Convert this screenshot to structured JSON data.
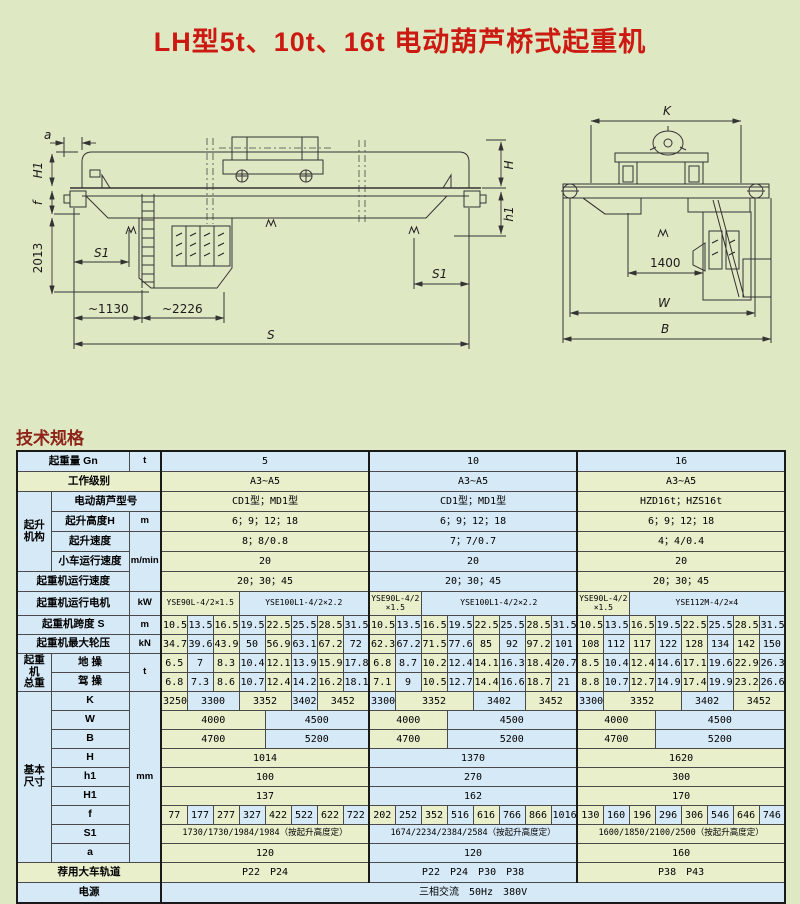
{
  "page": {
    "title": "LH型5t、10t、16t 电动葫芦桥式起重机",
    "section_title": "技术规格"
  },
  "colors": {
    "page_bg": "#dee9c4",
    "title_red": "#cc1a12",
    "section_red": "#8e2318",
    "cell_green": "#e9eecb",
    "cell_blue": "#d6e9f6",
    "line": "#333333"
  },
  "drawings": {
    "side": {
      "a": "a",
      "H1": "H1",
      "f": "f",
      "v2013": "2013",
      "s1": "S1",
      "d1130": "~1130",
      "d2226": "~2226",
      "S": "S",
      "H": "H",
      "h1": "h1"
    },
    "end": {
      "K": "K",
      "d1400": "1400",
      "W": "W",
      "B": "B"
    }
  },
  "table": {
    "capacity_sections": [
      "5",
      "10",
      "16"
    ],
    "rows": [
      {
        "id": "capacity",
        "rc": "h19",
        "cells": [
          {
            "t": "起重量 Gn",
            "k": "lab",
            "cs": 2
          },
          {
            "t": "t",
            "k": "unit"
          },
          {
            "t": "5",
            "cs": 8,
            "tn": "b"
          },
          {
            "t": "10",
            "cs": 8,
            "tn": "b"
          },
          {
            "t": "16",
            "cs": 8,
            "tn": "b"
          }
        ]
      },
      {
        "id": "duty-class",
        "rc": "h19",
        "cells": [
          {
            "t": "工作级别",
            "k": "lab",
            "cs": 3,
            "tn": "g"
          },
          {
            "t": "A3~A5",
            "cs": 8
          },
          {
            "t": "A3~A5",
            "cs": 8
          },
          {
            "t": "A3~A5",
            "cs": 8
          }
        ]
      },
      {
        "id": "hoist-model",
        "rc": "h19",
        "cells": [
          {
            "t": "起升\n机构",
            "k": "grp",
            "rs": 4
          },
          {
            "t": "电动葫芦型号",
            "k": "lab",
            "cs": 2
          },
          {
            "t": "CD1型；MD1型",
            "cs": 8
          },
          {
            "t": "CD1型；MD1型",
            "cs": 8
          },
          {
            "t": "HZD16t；HZS16t",
            "cs": 8
          }
        ]
      },
      {
        "id": "lift-height",
        "rc": "h19",
        "cells": [
          {
            "t": "起升高度H",
            "k": "lab"
          },
          {
            "t": "m",
            "k": "unit"
          },
          {
            "t": "6；9；12；18",
            "cs": 8
          },
          {
            "t": "6；9；12；18",
            "cs": 8
          },
          {
            "t": "6；9；12；18",
            "cs": 8
          }
        ]
      },
      {
        "id": "lift-speed",
        "rc": "h19",
        "cells": [
          {
            "t": "起升速度",
            "k": "lab"
          },
          {
            "t": "m/min",
            "k": "unit",
            "rs": 3
          },
          {
            "t": "8；8/0.8",
            "cs": 8
          },
          {
            "t": "7；7/0.7",
            "cs": 8
          },
          {
            "t": "4；4/0.4",
            "cs": 8
          }
        ]
      },
      {
        "id": "trolley-speed",
        "rc": "h19",
        "cells": [
          {
            "t": "小车运行速度",
            "k": "lab"
          },
          {
            "t": "20",
            "cs": 8
          },
          {
            "t": "20",
            "cs": 8
          },
          {
            "t": "20",
            "cs": 8
          }
        ]
      },
      {
        "id": "crane-speed",
        "rc": "h19",
        "cells": [
          {
            "t": "起重机运行速度",
            "k": "lab",
            "cs": 2
          },
          {
            "t": "20；30；45",
            "cs": 8
          },
          {
            "t": "20；30；45",
            "cs": 8
          },
          {
            "t": "20；30；45",
            "cs": 8
          }
        ]
      },
      {
        "id": "travel-motor",
        "rc": "h23 motors",
        "cells": [
          {
            "t": "起重机运行电机",
            "k": "lab",
            "cs": 2
          },
          {
            "t": "kW",
            "k": "unit"
          },
          {
            "t": "YSE90L-4/2×1.5",
            "cs": 3
          },
          {
            "t": "YSE100L1-4/2×2.2",
            "cs": 5
          },
          {
            "t": "YSE90L-4/2\n×1.5",
            "cs": 2
          },
          {
            "t": "YSE100L1-4/2×2.2",
            "cs": 6
          },
          {
            "t": "YSE90L-4/2\n×1.5",
            "cs": 2
          },
          {
            "t": "YSE112M-4/2×4",
            "cs": 6
          }
        ]
      },
      {
        "id": "span",
        "cells": [
          {
            "t": "起重机跨度 S",
            "k": "lab",
            "cs": 2
          },
          {
            "t": "m",
            "k": "unit"
          },
          {
            "t": "10.5"
          },
          {
            "t": "13.5"
          },
          {
            "t": "16.5"
          },
          {
            "t": "19.5"
          },
          {
            "t": "22.5"
          },
          {
            "t": "25.5"
          },
          {
            "t": "28.5"
          },
          {
            "t": "31.5"
          },
          {
            "t": "10.5"
          },
          {
            "t": "13.5"
          },
          {
            "t": "16.5"
          },
          {
            "t": "19.5"
          },
          {
            "t": "22.5"
          },
          {
            "t": "25.5"
          },
          {
            "t": "28.5"
          },
          {
            "t": "31.5"
          },
          {
            "t": "10.5"
          },
          {
            "t": "13.5"
          },
          {
            "t": "16.5"
          },
          {
            "t": "19.5"
          },
          {
            "t": "22.5"
          },
          {
            "t": "25.5"
          },
          {
            "t": "28.5"
          },
          {
            "t": "31.5"
          }
        ]
      },
      {
        "id": "max-wheel-load",
        "cells": [
          {
            "t": "起重机最大轮压",
            "k": "lab",
            "cs": 2
          },
          {
            "t": "kN",
            "k": "unit"
          },
          {
            "t": "34.7"
          },
          {
            "t": "39.6"
          },
          {
            "t": "43.9"
          },
          {
            "t": "50"
          },
          {
            "t": "56.9"
          },
          {
            "t": "63.1"
          },
          {
            "t": "67.2"
          },
          {
            "t": "72"
          },
          {
            "t": "62.3"
          },
          {
            "t": "67.2"
          },
          {
            "t": "71.5"
          },
          {
            "t": "77.6"
          },
          {
            "t": "85"
          },
          {
            "t": "92"
          },
          {
            "t": "97.2"
          },
          {
            "t": "101"
          },
          {
            "t": "108"
          },
          {
            "t": "112"
          },
          {
            "t": "117"
          },
          {
            "t": "122"
          },
          {
            "t": "128"
          },
          {
            "t": "134"
          },
          {
            "t": "142"
          },
          {
            "t": "150"
          }
        ]
      },
      {
        "id": "weight-ground",
        "cells": [
          {
            "t": "起重\n机\n总重",
            "k": "grp",
            "rs": 2
          },
          {
            "t": "地 操",
            "k": "lab"
          },
          {
            "t": "t",
            "k": "unit",
            "rs": 2
          },
          {
            "t": "6.5"
          },
          {
            "t": "7"
          },
          {
            "t": "8.3"
          },
          {
            "t": "10.4"
          },
          {
            "t": "12.1"
          },
          {
            "t": "13.9"
          },
          {
            "t": "15.9"
          },
          {
            "t": "17.8"
          },
          {
            "t": "6.8"
          },
          {
            "t": "8.7"
          },
          {
            "t": "10.2"
          },
          {
            "t": "12.4"
          },
          {
            "t": "14.1"
          },
          {
            "t": "16.3"
          },
          {
            "t": "18.4"
          },
          {
            "t": "20.7"
          },
          {
            "t": "8.5"
          },
          {
            "t": "10.4"
          },
          {
            "t": "12.4"
          },
          {
            "t": "14.6"
          },
          {
            "t": "17.1"
          },
          {
            "t": "19.6"
          },
          {
            "t": "22.9"
          },
          {
            "t": "26.3"
          }
        ]
      },
      {
        "id": "weight-cab",
        "cells": [
          {
            "t": "驾 操",
            "k": "lab"
          },
          {
            "t": "6.8"
          },
          {
            "t": "7.3"
          },
          {
            "t": "8.6"
          },
          {
            "t": "10.7"
          },
          {
            "t": "12.4"
          },
          {
            "t": "14.2"
          },
          {
            "t": "16.2"
          },
          {
            "t": "18.1"
          },
          {
            "t": "7.1"
          },
          {
            "t": "9"
          },
          {
            "t": "10.5"
          },
          {
            "t": "12.7"
          },
          {
            "t": "14.4"
          },
          {
            "t": "16.6"
          },
          {
            "t": "18.7"
          },
          {
            "t": "21"
          },
          {
            "t": "8.8"
          },
          {
            "t": "10.7"
          },
          {
            "t": "12.7"
          },
          {
            "t": "14.9"
          },
          {
            "t": "17.4"
          },
          {
            "t": "19.9"
          },
          {
            "t": "23.2"
          },
          {
            "t": "26.6"
          }
        ]
      },
      {
        "id": "dim-K",
        "cells": [
          {
            "t": "基本\n尺寸",
            "k": "grp",
            "rs": 9
          },
          {
            "t": "K",
            "k": "lab"
          },
          {
            "t": "mm",
            "k": "unit",
            "rs": 9
          },
          {
            "t": "3250"
          },
          {
            "t": "3300",
            "cs": 2
          },
          {
            "t": "3352",
            "cs": 2
          },
          {
            "t": "3402"
          },
          {
            "t": "3452",
            "cs": 2
          },
          {
            "t": "3300"
          },
          {
            "t": "3352",
            "cs": 3
          },
          {
            "t": "3402",
            "cs": 2
          },
          {
            "t": "3452",
            "cs": 2
          },
          {
            "t": "3300"
          },
          {
            "t": "3352",
            "cs": 3
          },
          {
            "t": "3402",
            "cs": 2
          },
          {
            "t": "3452",
            "cs": 2
          }
        ]
      },
      {
        "id": "dim-W",
        "cells": [
          {
            "t": "W",
            "k": "lab"
          },
          {
            "t": "4000",
            "cs": 4
          },
          {
            "t": "4500",
            "cs": 4
          },
          {
            "t": "4000",
            "cs": 3
          },
          {
            "t": "4500",
            "cs": 5
          },
          {
            "t": "4000",
            "cs": 3
          },
          {
            "t": "4500",
            "cs": 5
          }
        ]
      },
      {
        "id": "dim-B",
        "cells": [
          {
            "t": "B",
            "k": "lab"
          },
          {
            "t": "4700",
            "cs": 4
          },
          {
            "t": "5200",
            "cs": 4
          },
          {
            "t": "4700",
            "cs": 3
          },
          {
            "t": "5200",
            "cs": 5
          },
          {
            "t": "4700",
            "cs": 3
          },
          {
            "t": "5200",
            "cs": 5
          }
        ]
      },
      {
        "id": "dim-H",
        "cells": [
          {
            "t": "H",
            "k": "lab"
          },
          {
            "t": "1014",
            "cs": 8
          },
          {
            "t": "1370",
            "cs": 8
          },
          {
            "t": "1620",
            "cs": 8
          }
        ]
      },
      {
        "id": "dim-h1",
        "cells": [
          {
            "t": "h1",
            "k": "lab"
          },
          {
            "t": "100",
            "cs": 8
          },
          {
            "t": "270",
            "cs": 8
          },
          {
            "t": "300",
            "cs": 8
          }
        ]
      },
      {
        "id": "dim-H1",
        "cells": [
          {
            "t": "H1",
            "k": "lab"
          },
          {
            "t": "137",
            "cs": 8
          },
          {
            "t": "162",
            "cs": 8
          },
          {
            "t": "170",
            "cs": 8
          }
        ]
      },
      {
        "id": "dim-f",
        "cells": [
          {
            "t": "f",
            "k": "lab"
          },
          {
            "t": "77"
          },
          {
            "t": "177"
          },
          {
            "t": "277"
          },
          {
            "t": "327"
          },
          {
            "t": "422"
          },
          {
            "t": "522"
          },
          {
            "t": "622"
          },
          {
            "t": "722"
          },
          {
            "t": "202"
          },
          {
            "t": "252"
          },
          {
            "t": "352"
          },
          {
            "t": "516"
          },
          {
            "t": "616"
          },
          {
            "t": "766"
          },
          {
            "t": "866"
          },
          {
            "t": "1016"
          },
          {
            "t": "130"
          },
          {
            "t": "160"
          },
          {
            "t": "196"
          },
          {
            "t": "296"
          },
          {
            "t": "306"
          },
          {
            "t": "546"
          },
          {
            "t": "646"
          },
          {
            "t": "746"
          }
        ]
      },
      {
        "id": "dim-S1",
        "rc": "fine",
        "cells": [
          {
            "t": "S1",
            "k": "lab"
          },
          {
            "t": "1730/1730/1984/1984（按起升高度定）",
            "cs": 8
          },
          {
            "t": "1674/2234/2384/2584（按起升高度定）",
            "cs": 8
          },
          {
            "t": "1600/1850/2100/2500（按起升高度定）",
            "cs": 8
          }
        ]
      },
      {
        "id": "dim-a",
        "cells": [
          {
            "t": "a",
            "k": "lab"
          },
          {
            "t": "120",
            "cs": 8
          },
          {
            "t": "120",
            "cs": 8
          },
          {
            "t": "160",
            "cs": 8
          }
        ]
      },
      {
        "id": "rail",
        "rc": "h19",
        "cells": [
          {
            "t": "荐用大车轨道",
            "k": "lab",
            "cs": 3,
            "tn": "g"
          },
          {
            "t": "P22　P24",
            "cs": 8
          },
          {
            "t": "P22　P24　P30　P38",
            "cs": 8
          },
          {
            "t": "P38　P43",
            "cs": 8
          }
        ]
      },
      {
        "id": "power",
        "rc": "h19",
        "cells": [
          {
            "t": "电源",
            "k": "lab",
            "cs": 3
          },
          {
            "t": "三相交流　50Hz　380V",
            "cs": 24,
            "tn": "b"
          }
        ]
      }
    ]
  }
}
